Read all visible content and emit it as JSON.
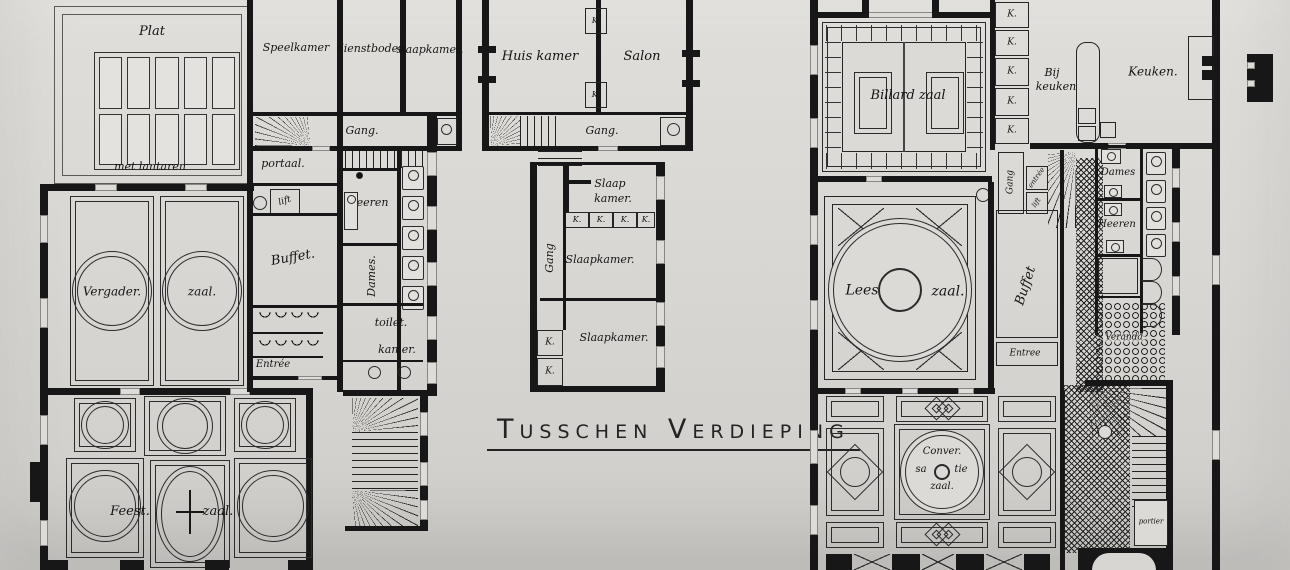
{
  "title": "Tusschen Verdieping",
  "colors": {
    "paper": "#d9d7d3",
    "ink": "#1a1a1a"
  },
  "left_wing": {
    "plat": "Plat",
    "met_lantaren": "met lantaren",
    "speelkamer": "Speelkamer",
    "dienstboden": "dienstboden",
    "slaapkamer": "slaapkamer.",
    "gang": "Gang.",
    "portaal": "portaal.",
    "lift": "lift",
    "heeren": "heeren",
    "dames": "Dames.",
    "toilet_line1": "toilet.",
    "toilet_line2": "kamer.",
    "buffet": "Buffet.",
    "entree": "Entrée",
    "vergader_line1": "Vergader.",
    "vergader_line2": "zaal.",
    "feest_line1": "Feest.",
    "feest_line2": "zaal."
  },
  "middle_wing": {
    "huiskamer": "Huis kamer",
    "salon": "Salon",
    "gang": "Gang.",
    "gang_vertical": "Gang",
    "slaap_line1": "Slaap",
    "slaap_line2": "kamer.",
    "slaapkamer": "Slaapkamer.",
    "kast": "K."
  },
  "right_wing": {
    "billard": "Billard zaal",
    "kast": "K.",
    "bij_line1": "Bij",
    "bij_line2": "keuken",
    "keuken": "Keuken.",
    "gang_vertical": "Gang",
    "entree_small": "entrée",
    "lift": "lift",
    "lees_line1": "Lees",
    "lees_line2": "zaal.",
    "buffet": "Buffet",
    "entree": "Entree",
    "dames": "Dames",
    "heeren": "Heeren",
    "veranda": "Veranda",
    "portier": "portier",
    "conver_line1": "Conver.",
    "conver_line2": "sa",
    "conver_line3": "tie",
    "conver_line4": "zaal."
  }
}
